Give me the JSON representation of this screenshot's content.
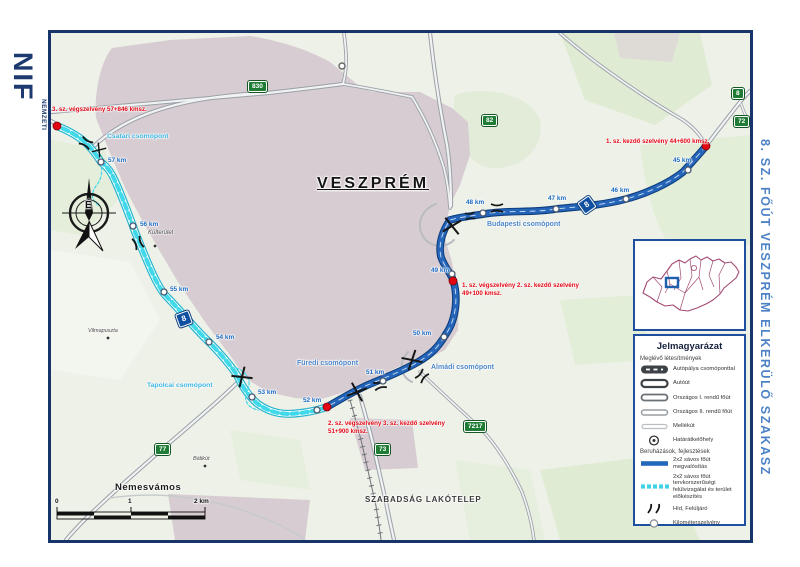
{
  "branding": {
    "logo": "NIF",
    "org_lines": [
      "NEMZETI",
      "INFRASTRUKTÚRA",
      "FEJLESZTŐ ZRT."
    ]
  },
  "side_title": "8. SZ. FŐÚT VESZPRÉM ELKERÜLŐ SZAKASZ",
  "map": {
    "city": "VESZPRÉM",
    "places": {
      "kulterulet": "Külterület",
      "vilmapuszta": "Vilmapuszta",
      "balikut": "Bálikút",
      "nemesvamos": "Nemesvámos",
      "szabadsag": "SZABADSÁG LAKÓTELEP"
    },
    "junctions": {
      "csatari": "Csatári csomópont",
      "budapesti": "Budapesti csomópont",
      "tapolcai": "Tapolcai csomópont",
      "furedi": "Füredi csomópont",
      "almadi": "Almádi csomópont"
    },
    "shields": {
      "green": [
        "830",
        "82",
        "8",
        "72",
        "77",
        "73",
        "7217"
      ],
      "blue": [
        "8",
        "8"
      ]
    },
    "km_markers": [
      "45 km",
      "46 km",
      "47 km",
      "48 km",
      "49 km",
      "50 km",
      "51 km",
      "52 km",
      "53 km",
      "54 km",
      "55 km",
      "56 km",
      "57 km"
    ],
    "annotations": [
      {
        "line1": "3. sz. végszelvény 57+846 kmsz.",
        "line2": ""
      },
      {
        "line1": "1. sz. kezdő szelvény 44+600 kmsz.",
        "line2": ""
      },
      {
        "line1": "1. sz. végszelvény 2. sz. kezdő szelvény",
        "line2": "49+100 kmsz."
      },
      {
        "line1": "2. sz. végszelvény 3. sz. kezdő szelvény",
        "line2": "51+900 kmsz."
      }
    ],
    "compass_north": "É",
    "scale_bar": {
      "labels": [
        "0",
        "1",
        "2 km"
      ]
    }
  },
  "legend": {
    "title": "Jelmagyarázat",
    "sections": [
      {
        "heading": "Meglévő létesítmények",
        "items": [
          {
            "label": "Autópálya csomóponttal"
          },
          {
            "label": "Autóút"
          },
          {
            "label": "Országos I. rendű főút"
          },
          {
            "label": "Országos II. rendű főút"
          },
          {
            "label": "Mellékút"
          },
          {
            "label": "Határátkelőhely"
          }
        ]
      },
      {
        "heading": "Beruházások, fejlesztések",
        "items": [
          {
            "label": "2x2 sávos főút megvalósítás"
          },
          {
            "label": "2x2 sávos főút tervkorszerűségi felülvizsgálat és terület előkészítés"
          },
          {
            "label": "Híd, Felüljáró"
          },
          {
            "label": "Kilométerszelvény"
          }
        ]
      }
    ]
  },
  "colors": {
    "frame_navy": "#17346b",
    "title_blue": "#4d82c6",
    "road_new_blue": "#2566ba",
    "road_planned_cyan": "#3fd9ea",
    "annotation_red": "#e30613",
    "shield_green": "#1e7c35",
    "shield_blue": "#1050a0",
    "urban_mauve": "#d7ccd2"
  }
}
